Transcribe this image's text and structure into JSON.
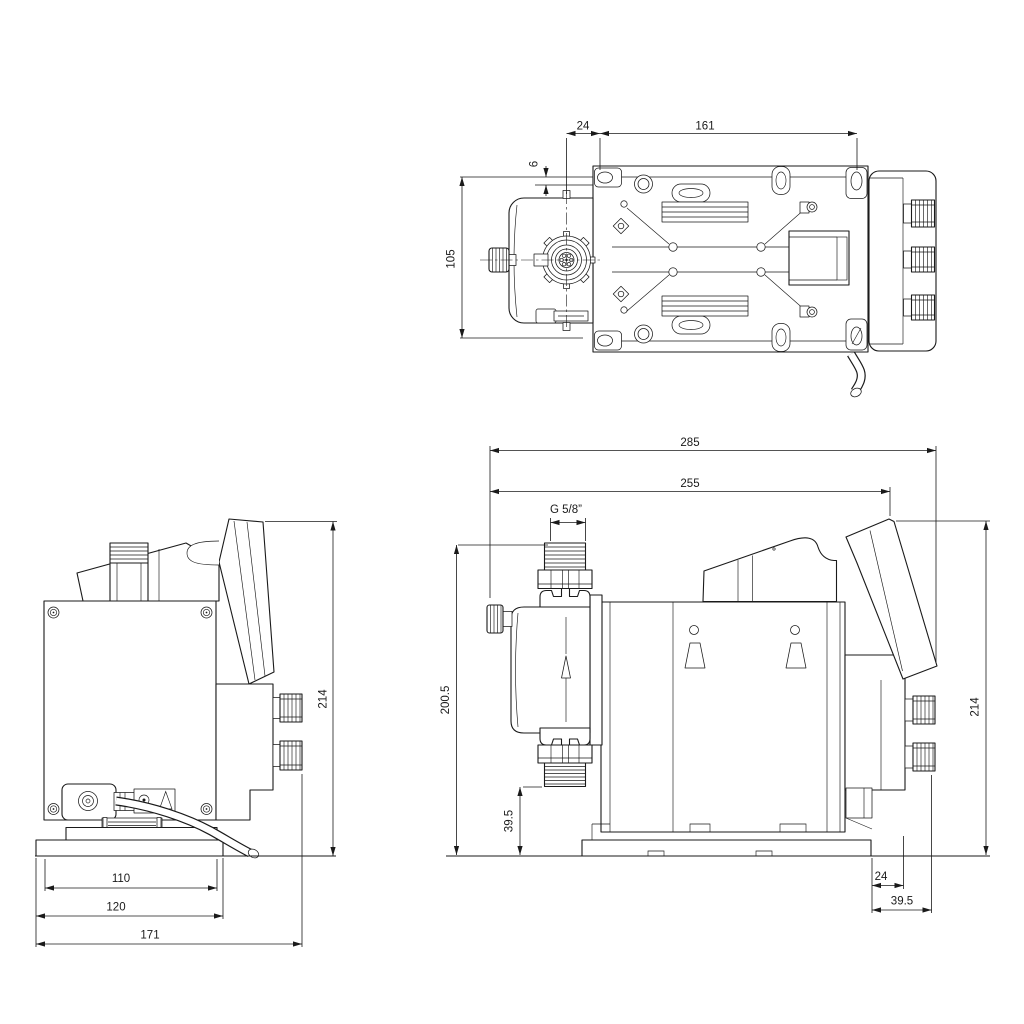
{
  "drawing": {
    "kind": "technical-dimensional-drawing",
    "line_color": "#1a1a1a",
    "background_color": "#ffffff",
    "views": {
      "top": {
        "dims": {
          "d24": "24",
          "d161": "161",
          "d6": "6",
          "d105": "105"
        }
      },
      "back": {
        "dims": {
          "d214": "214",
          "d110": "110",
          "d120": "120",
          "d171": "171"
        }
      },
      "side": {
        "dims": {
          "d285": "285",
          "d255": "255",
          "thread": "G 5/8”",
          "d200_5": "200.5",
          "d39_5_left": "39.5",
          "d214": "214",
          "d24": "24",
          "d39_5_bottom": "39.5"
        }
      }
    }
  }
}
